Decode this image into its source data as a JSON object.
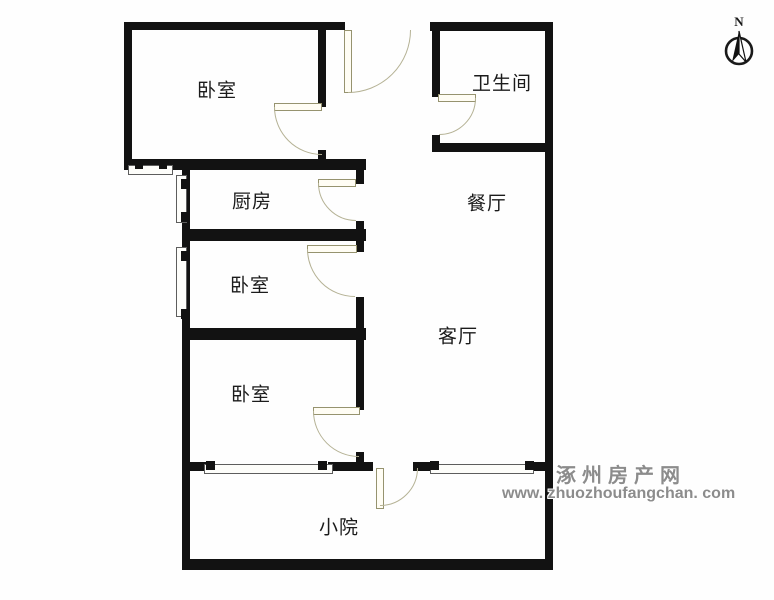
{
  "floor_plan": {
    "rooms": [
      {
        "id": "bedroom-top-left",
        "label": "卧室"
      },
      {
        "id": "bathroom",
        "label": "卫生间"
      },
      {
        "id": "kitchen",
        "label": "厨房"
      },
      {
        "id": "dining-room",
        "label": "餐厅"
      },
      {
        "id": "bedroom-middle-left",
        "label": "卧室"
      },
      {
        "id": "living-room",
        "label": "客厅"
      },
      {
        "id": "bedroom-bottom-left",
        "label": "卧室"
      },
      {
        "id": "courtyard",
        "label": "小院"
      }
    ],
    "compass": {
      "north_label": "N"
    },
    "watermark": {
      "site_name": "涿州房产网",
      "site_url": "www. zhuozhoufangchan. com"
    },
    "colors": {
      "wall": "#121212",
      "door_arc": "#b5b295",
      "door_leaf": "#fffdf4",
      "watermark_gray": "#8c8c8c"
    }
  }
}
